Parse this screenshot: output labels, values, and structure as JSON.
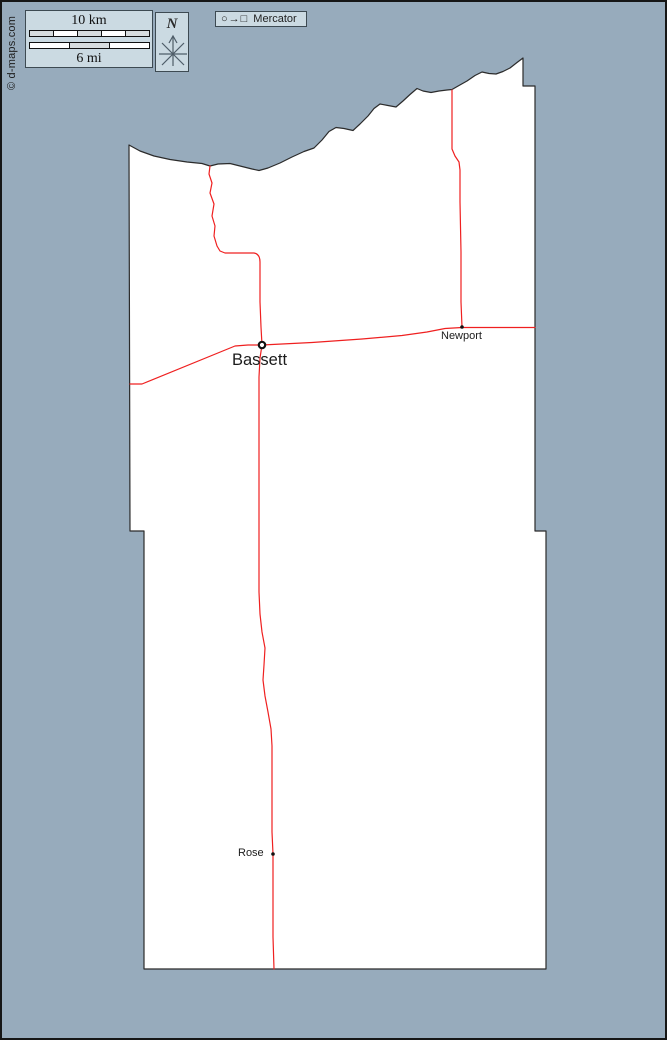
{
  "colors": {
    "bg": "#97abbc",
    "frame": "#161616",
    "panel": "#cbdae2",
    "panel_border": "#3d4a52",
    "county_fill": "#ffffff",
    "county_stroke": "#2b2b2b",
    "road": "#ef2020",
    "ink": "#1c1c1c",
    "compass": "#4e5d68"
  },
  "copyright": "© d-maps.com",
  "scale_panel": {
    "km_label": "10 km",
    "mi_label": "6 mi"
  },
  "north_panel": {
    "label": "N"
  },
  "projection_panel": {
    "glyphs": "○→□",
    "label": "Mercator"
  },
  "map": {
    "county_path": "M 127,143 L 138,149 L 152,154 L 168,157.5 L 185,160 L 200,161.5 L 208,164 L 216,162 L 228,161.5 L 240,164.5 L 250,167 L 257,168.5 L 266,166 L 278,161 L 290,155 L 302,149.5 L 312,146 L 320,138 L 327,129.5 L 334,125.5 L 342,126.5 L 351,128.5 L 358,122 L 366,114 L 372,106.5 L 378,102 L 386,103.5 L 394,105 L 401,99 L 408,92.5 L 415,86.5 L 421,89 L 429,90.5 L 437,89 L 445,88 L 450,87.5 L 457,83.5 L 465,79 L 473,73.5 L 480,70 L 487,71.5 L 494,72 L 501,69.5 L 508,66 L 515,60.5 L 521,56 L 521,84 L 533,84 L 533,529 L 544,529 L 544,967 L 142,967 L 142,529 L 128,529 Z",
    "roads": [
      {
        "name": "road-north-to-bassett",
        "path": "M 208,164 L 207,172 L 210,181 L 208,191 L 212,202 L 210,214 L 213,224 L 212,234 L 215,244 L 218,249 L 223,251 L 252,251 Q 258,252 258,260 L 258,300 L 259,325 L 260,343"
      },
      {
        "name": "road-north-to-newport",
        "path": "M 450,88 L 450,120 L 450,147 L 453,154 L 457,160 L 458,168 L 458,200 L 459,250 L 459,300 L 460,325"
      },
      {
        "name": "road-east-west",
        "path": "M 128,382 L 140,382 L 233,344 L 246,343 L 260,343 L 310,340.5 L 360,337 L 400,333.5 L 425,330 L 443,326.5 L 460,325.5 L 533,325.5"
      },
      {
        "name": "road-south",
        "path": "M 260,343 L 258,356 L 257,375 L 257,430 L 257,500 L 257,560 L 257,590 L 258,612 L 260,630 L 263,646 L 262,663 L 261,678 L 263,694 L 266,710 L 269,727 L 270,744 L 270,790 L 270,830 L 271,852 L 271,900 L 271,935 L 272,967"
      }
    ],
    "towns": [
      {
        "name": "Bassett",
        "x": 260,
        "y": 343
      },
      {
        "name": "Newport",
        "x": 460,
        "y": 325
      },
      {
        "name": "Rose",
        "x": 271,
        "y": 852
      }
    ]
  }
}
